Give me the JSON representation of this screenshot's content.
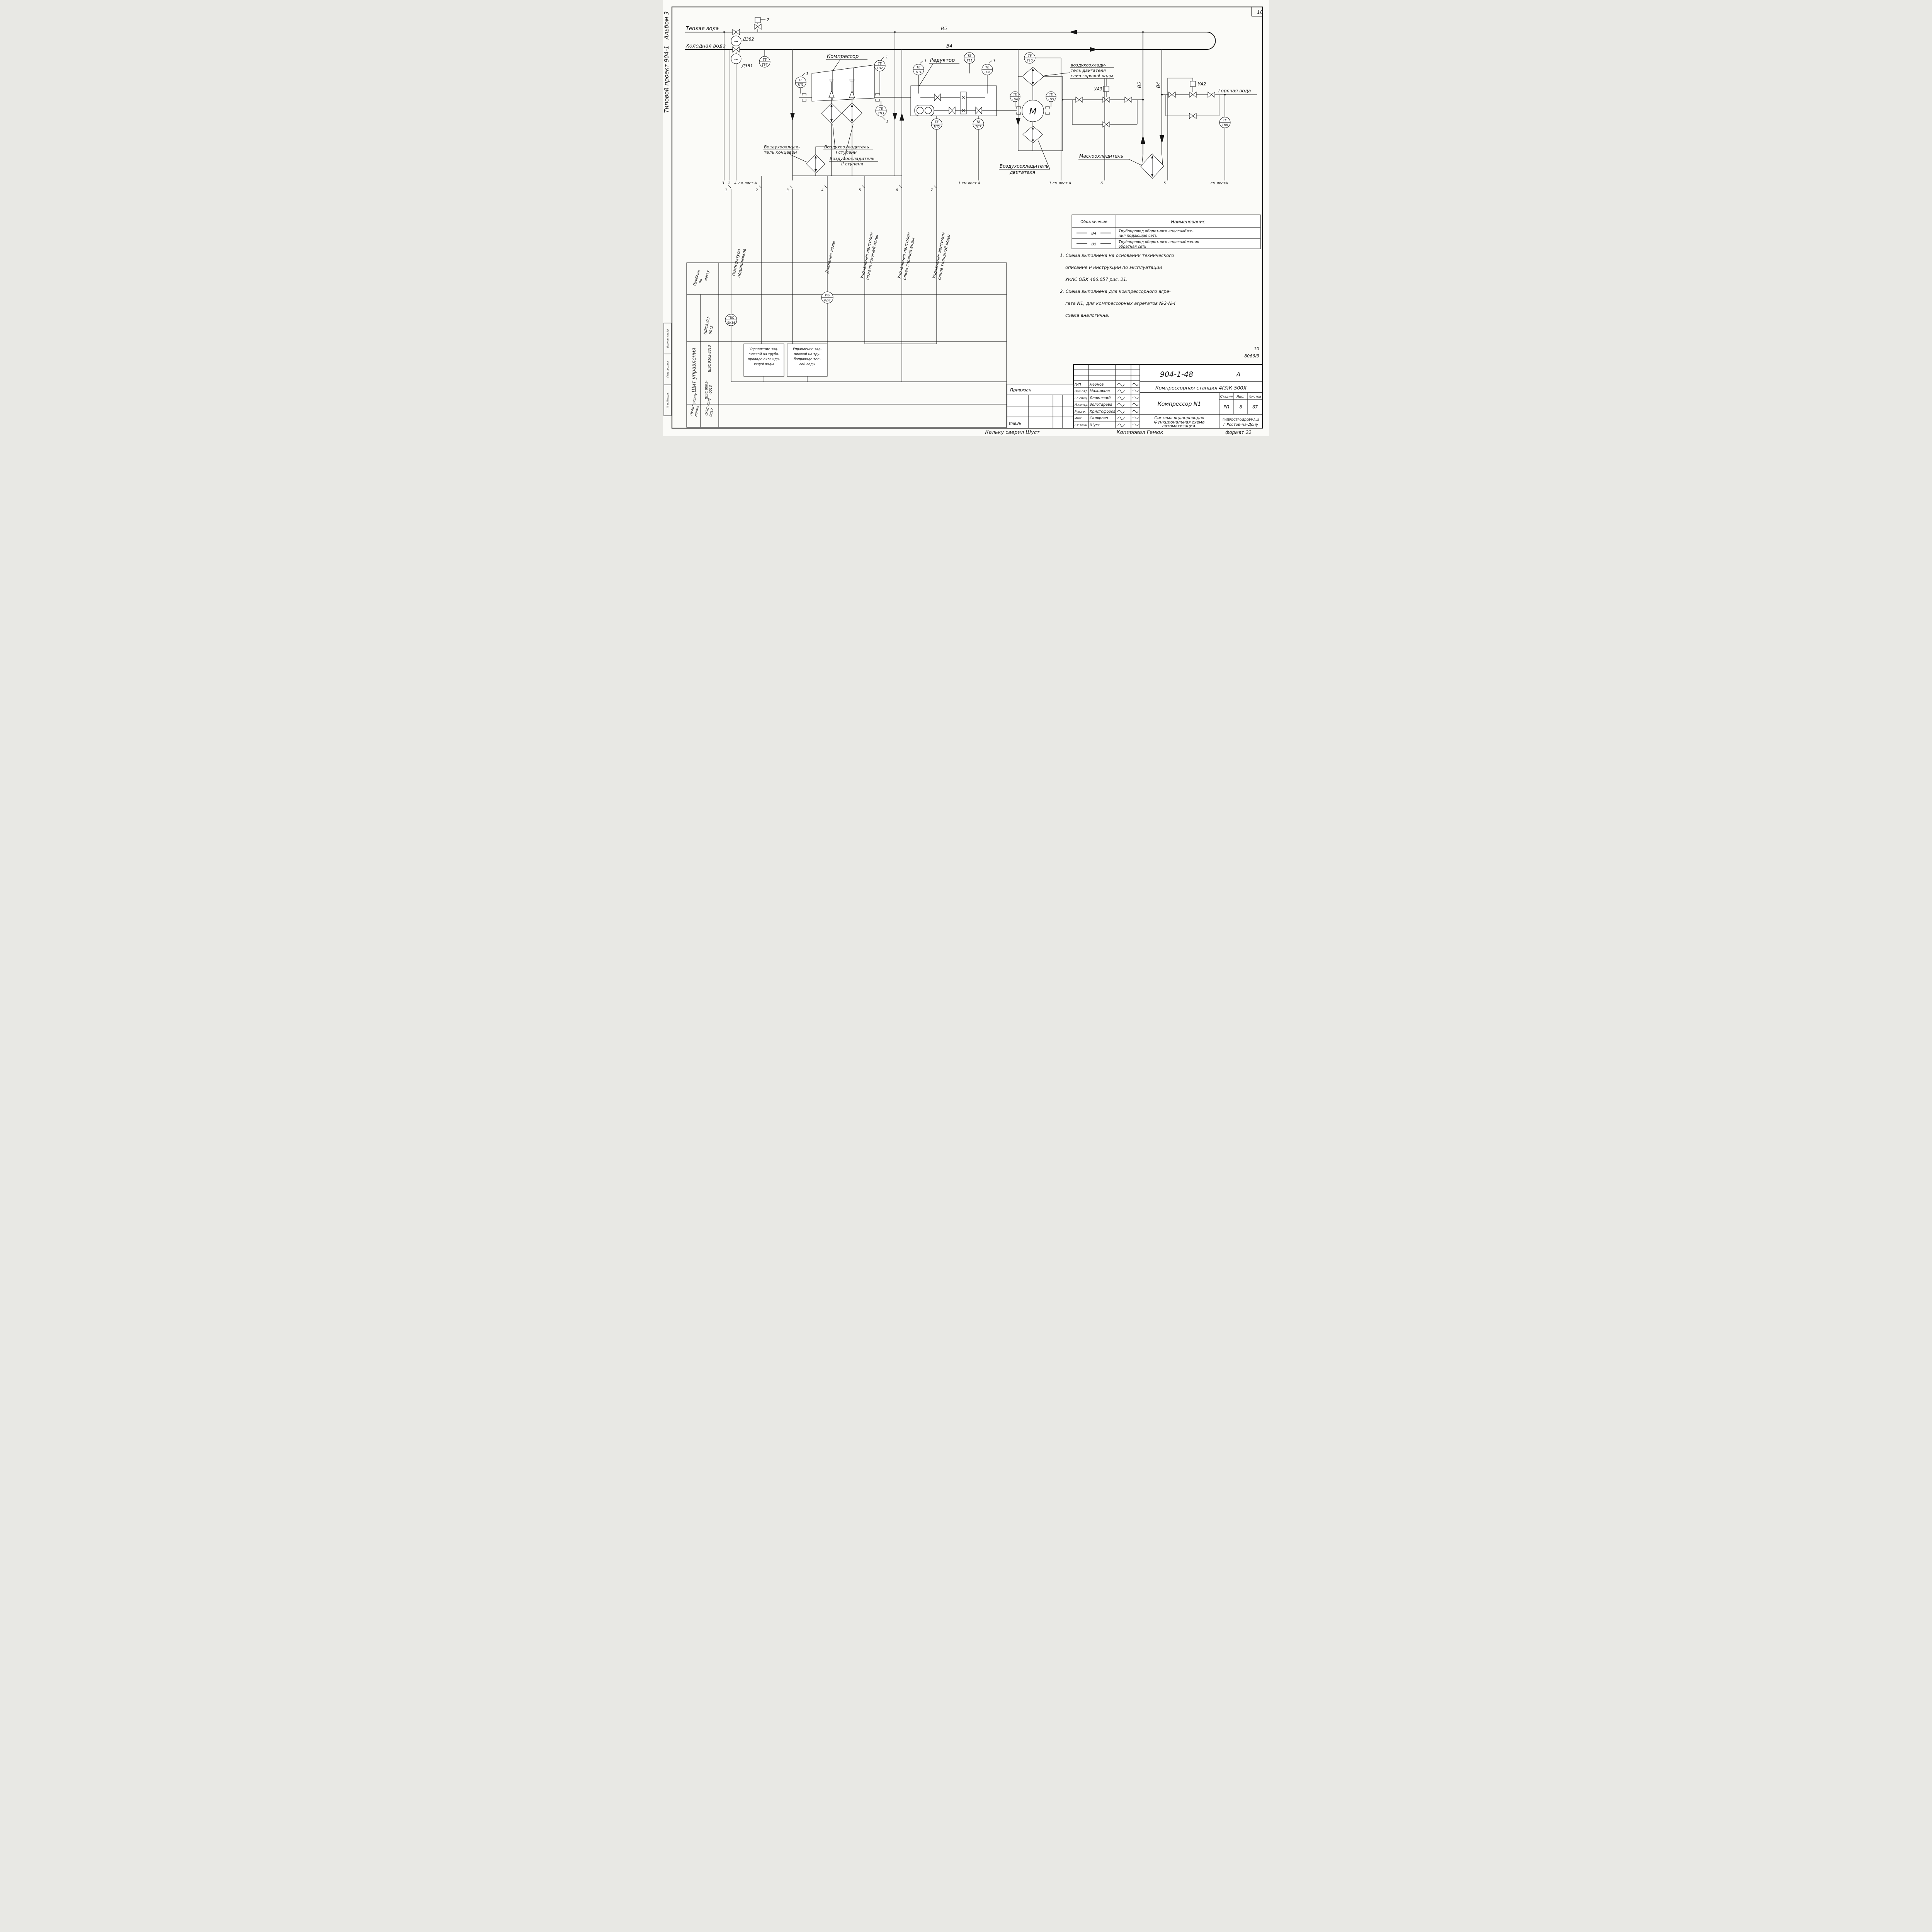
{
  "page": {
    "corner_number": "10",
    "album_label": "Альбом 3",
    "project_label": "Типовой проект 904-1",
    "margin_rows": [
      "Взамен.инв.№",
      "Подп.и дата",
      "Инв.№подл."
    ],
    "doc_small_number": "10",
    "doc_small_code": "8066/3",
    "traced_by": "Кальку сверил  Шуст",
    "copied_by": "Копировал  Генюк",
    "format_label": "формат 22"
  },
  "pipes": {
    "warm_water": "Теплая вода",
    "cold_water": "Холодная вода",
    "hot_water": "Горячая вода",
    "b5": "В5",
    "b4": "В4",
    "b5_vert": "В5",
    "b4_vert": "В4"
  },
  "equipment": {
    "compressor": "Компрессор",
    "reducer": "Редуктор",
    "motor_letter": "М",
    "end_cooler": [
      "Воздухоохлади-",
      "тель концевой"
    ],
    "stage1_cooler": [
      "Воздухоохладитель",
      "I ступени"
    ],
    "stage2_cooler": [
      "Воздухоохладитель",
      "II ступени"
    ],
    "engine_cooler_drain": [
      "воздухоохлади-",
      "тель двигателя",
      "слив горячей воды"
    ],
    "engine_cooler": [
      "Воздухоохладитель",
      "двигателя"
    ],
    "oil_cooler": "Маслоохладитель"
  },
  "instruments": {
    "d382": "Д382",
    "d381": "Д381",
    "tilde": "~",
    "t87": [
      "ТЕ",
      "Т87"
    ],
    "tp1": [
      "ТЕ",
      "ТП1"
    ],
    "tp2": [
      "ТЕ",
      "ТП2"
    ],
    "tp3": [
      "ТЕ",
      "ТП3"
    ],
    "tp4": [
      "ТЕ",
      "ТП4"
    ],
    "tp5": [
      "ТЕ",
      "ТП5"
    ],
    "tp6": [
      "ТЕ",
      "ТП6"
    ],
    "tp7": [
      "ТЕ",
      "ТП7"
    ],
    "tp8": [
      "ТЕ",
      "ТП8"
    ],
    "tp9": [
      "ТЕ",
      "ТП9"
    ],
    "t10": [
      "ТЕ",
      "Т10"
    ],
    "t11": [
      "ТЕ",
      "Т11"
    ],
    "tb8": [
      "ТЕ",
      "ТВ8"
    ],
    "trc": [
      "TRC",
      "ЛК16"
    ],
    "pis": [
      "PIS",
      "РД8"
    ],
    "ua3": "УА3",
    "ua2": "УА2",
    "relief": "7"
  },
  "takeoffs": {
    "row_a": [
      "3",
      "2",
      "4",
      "см.лист А"
    ],
    "flags": [
      "1",
      "2",
      "3",
      "4",
      "5",
      "6",
      "7"
    ],
    "right": [
      "1 см.лист А",
      "1 см.лист А",
      "6",
      "5",
      "см.листА"
    ]
  },
  "signals": {
    "s1": [
      "Температура",
      "подшипников"
    ],
    "s4": "Давление воды",
    "s5": [
      "Управление вентилем",
      "подачи горячей воды"
    ],
    "s6": [
      "Управление вентилем",
      "слива горячей воды"
    ],
    "s7": [
      "Управление вентилем",
      "слива холодной воды"
    ]
  },
  "panel": {
    "row_local": [
      "Приборы",
      "по",
      "месту"
    ],
    "id_local": [
      "ЩЭС8503-",
      "-0012"
    ],
    "row_board": "Щит управления",
    "id_board1": "ШЭС 9102-3313",
    "id_board2": [
      "ШЭС 8801-",
      "-0013"
    ],
    "row_console": [
      "Пульт управ-",
      "ления"
    ],
    "id_console": [
      "ШЭС 9006-",
      "0012"
    ],
    "box1": [
      "Управление зад-",
      "вижкой на трубо-",
      "проводе охлажда-",
      "ющей воды"
    ],
    "box2": [
      "Управление зад-",
      "вижкой на тру-",
      "бопроводе теп-",
      "лой воды"
    ]
  },
  "legend": {
    "h1": "Обозначение",
    "h2": "Наименование",
    "r1s": "В4",
    "r1n": [
      "Трубопровод оборотного водоснабже-",
      "ния подающая сеть"
    ],
    "r2s": "В5",
    "r2n": [
      "Трубопровод оборотного водоснабжения",
      "обратная сеть"
    ]
  },
  "notes": [
    "1. Схема выполнена на основании технического",
    "описания и инструкции  по эксплуатации",
    "УКАС ОБХ 466.057  рис. 21.",
    "2. Схема выполнена  для компрессорного агре-",
    "гата N1, для компрессорных агрегатов №2-№4",
    "схема аналогична."
  ],
  "titleblock": {
    "doc_number": "904-1-48",
    "revision": "А",
    "station": "Компрессорная станция 4(3)К-500Я",
    "unit": "Компрессор N1",
    "col_stage": "Стадия",
    "col_sheet": "Лист",
    "col_sheets": "Листов",
    "stage": "РП",
    "sheet": "8",
    "sheets": "67",
    "drawing_title": [
      "Система водопроводов",
      "Функциональная схема",
      "автоматизации."
    ],
    "organization": [
      "ГИПРОСТРОЙДОРМАШ",
      "г Ростов-на-Дону"
    ],
    "attached": "Привязан",
    "inventory": "Инв.№",
    "roles": [
      {
        "role": "ГИП",
        "name": "Леонов"
      },
      {
        "role": "Нач.отд.",
        "name": "Мажников"
      },
      {
        "role": "Гл.спец.",
        "name": "Левинский"
      },
      {
        "role": "Н.контр.",
        "name": "Золотарева"
      },
      {
        "role": "Рук.гр.",
        "name": "Христофоров"
      },
      {
        "role": "Инж.",
        "name": "Склярово"
      },
      {
        "role": "Ст.техн.",
        "name": "Шуст"
      }
    ]
  }
}
